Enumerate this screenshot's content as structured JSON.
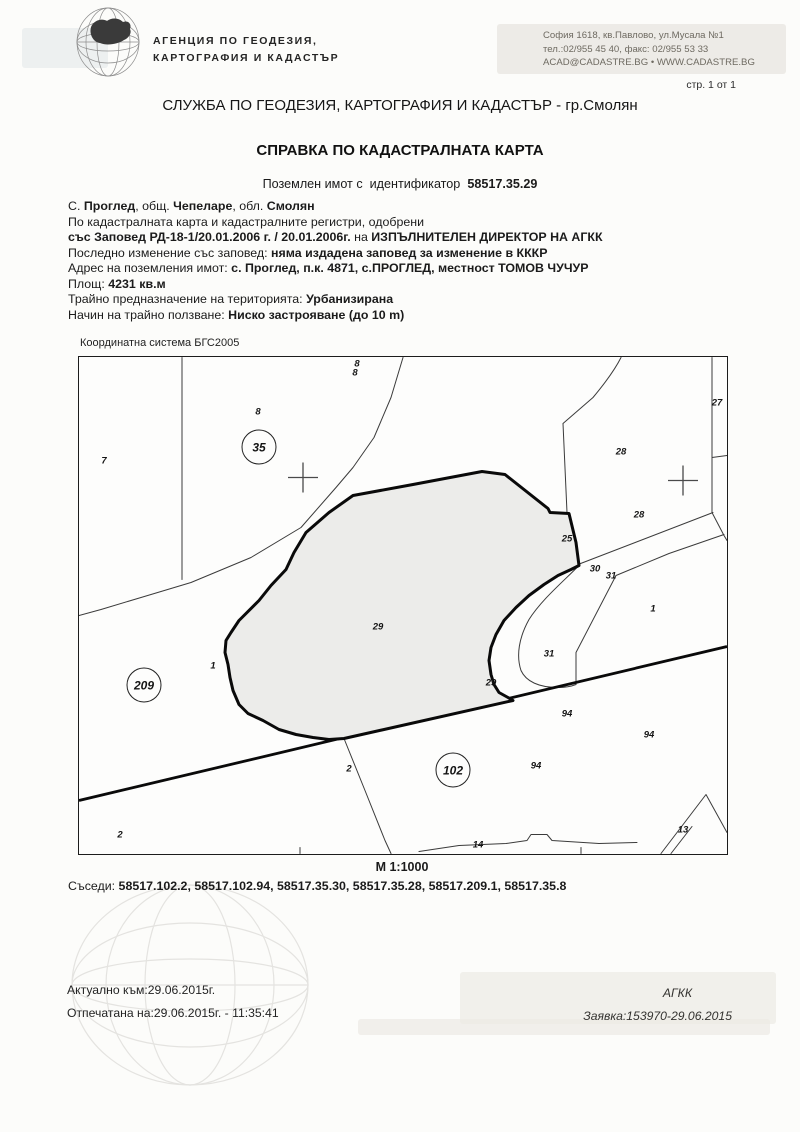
{
  "page": {
    "page_number": "стр. 1 от 1",
    "paper_color": "#fcfcfa"
  },
  "header": {
    "agency_name_line1": "АГЕНЦИЯ ПО ГЕОДЕЗИЯ,",
    "agency_name_line2": "КАРТОГРАФИЯ И КАДАСТЪР",
    "address_line1": "София 1618, кв.Павлово, ул.Мусала №1",
    "address_line2": "тел.:02/955 45 40, факс: 02/955 53 33",
    "address_line3": "ACAD@CADASTRE.BG • WWW.CADASTRE.BG"
  },
  "titles": {
    "service": "СЛУЖБА ПО ГЕОДЕЗИЯ, КАРТОГРАФИЯ И КАДАСТЪР - гр.Смолян",
    "document": "СПРАВКА ПО КАДАСТРАЛНАТА КАРТА",
    "parcel_prefix": "Поземлен имот с  идентификатор  ",
    "parcel_id": "58517.35.29"
  },
  "details": {
    "lines": [
      [
        {
          "t": "С. "
        },
        {
          "t": "Проглед",
          "b": 1
        },
        {
          "t": ", общ. "
        },
        {
          "t": "Чепеларе",
          "b": 1
        },
        {
          "t": ", обл. "
        },
        {
          "t": "Смолян",
          "b": 1
        }
      ],
      [
        {
          "t": "По кадастралната карта и кадастралните регистри, одобрени"
        }
      ],
      [
        {
          "t": "със Заповед РД-18-1/20.01.2006 г. / 20.01.2006г.",
          "b": 1
        },
        {
          "t": " на "
        },
        {
          "t": "ИЗПЪЛНИТЕЛЕН ДИРЕКТОР НА АГКК",
          "b": 1
        }
      ],
      [
        {
          "t": "Последно изменение със заповед: "
        },
        {
          "t": "няма издадена заповед за изменение в КККР",
          "b": 1
        }
      ],
      [
        {
          "t": "Адрес на поземления имот: "
        },
        {
          "t": "с. Проглед, п.к. 4871, с.ПРОГЛЕД, местност ТОМОВ ЧУЧУР",
          "b": 1
        }
      ],
      [
        {
          "t": "Площ: "
        },
        {
          "t": "4231 кв.м",
          "b": 1
        }
      ],
      [
        {
          "t": "Трайно предназначение на територията: "
        },
        {
          "t": "Урбанизирана",
          "b": 1
        }
      ],
      [
        {
          "t": "Начин на трайно ползване: "
        },
        {
          "t": "Ниско застрояване (до 10 m)",
          "b": 1
        }
      ]
    ]
  },
  "map": {
    "coordinate_system": "Координатна система БГС2005",
    "scale": "М 1:1000",
    "parcel_fill_color": "#ececea",
    "boundary_color": "#0a0a0a",
    "thin_line_color": "#3b3b3b",
    "labels": [
      {
        "t": "8",
        "x": 278,
        "y": 7
      },
      {
        "t": "8",
        "x": 276,
        "y": 16
      },
      {
        "t": "8",
        "x": 179,
        "y": 55
      },
      {
        "t": "7",
        "x": 25,
        "y": 104
      },
      {
        "t": "27",
        "x": 638,
        "y": 46
      },
      {
        "t": "28",
        "x": 542,
        "y": 95
      },
      {
        "t": "28",
        "x": 560,
        "y": 158
      },
      {
        "t": "25",
        "x": 488,
        "y": 182
      },
      {
        "t": "30",
        "x": 516,
        "y": 212
      },
      {
        "t": "31",
        "x": 532,
        "y": 219
      },
      {
        "t": "1",
        "x": 574,
        "y": 252
      },
      {
        "t": "29",
        "x": 299,
        "y": 270
      },
      {
        "t": "31",
        "x": 470,
        "y": 297
      },
      {
        "t": "1",
        "x": 134,
        "y": 309
      },
      {
        "t": "29",
        "x": 412,
        "y": 326
      },
      {
        "t": "94",
        "x": 488,
        "y": 357
      },
      {
        "t": "94",
        "x": 570,
        "y": 378
      },
      {
        "t": "94",
        "x": 457,
        "y": 409
      },
      {
        "t": "2",
        "x": 270,
        "y": 412
      },
      {
        "t": "2",
        "x": 41,
        "y": 478
      },
      {
        "t": "13",
        "x": 604,
        "y": 473
      },
      {
        "t": "14",
        "x": 399,
        "y": 488
      }
    ],
    "circles": [
      {
        "t": "35",
        "x": 180,
        "y": 90
      },
      {
        "t": "209",
        "x": 65,
        "y": 328
      },
      {
        "t": "102",
        "x": 374,
        "y": 413
      }
    ]
  },
  "neighbors": {
    "segments": [
      {
        "t": "Съседи: "
      },
      {
        "t": "58517.102.2, 58517.102.94, 58517.35.30, 58517.35.28, 58517.209.1, 58517.35.8",
        "b": 1
      }
    ]
  },
  "footer": {
    "current_as_of": "Актуално към:29.06.2015г.",
    "printed_on": "Отпечатана на:29.06.2015г. - 11:35:41",
    "agency_abbr": "АГКК",
    "request": "Заявка:153970-29.06.2015"
  }
}
